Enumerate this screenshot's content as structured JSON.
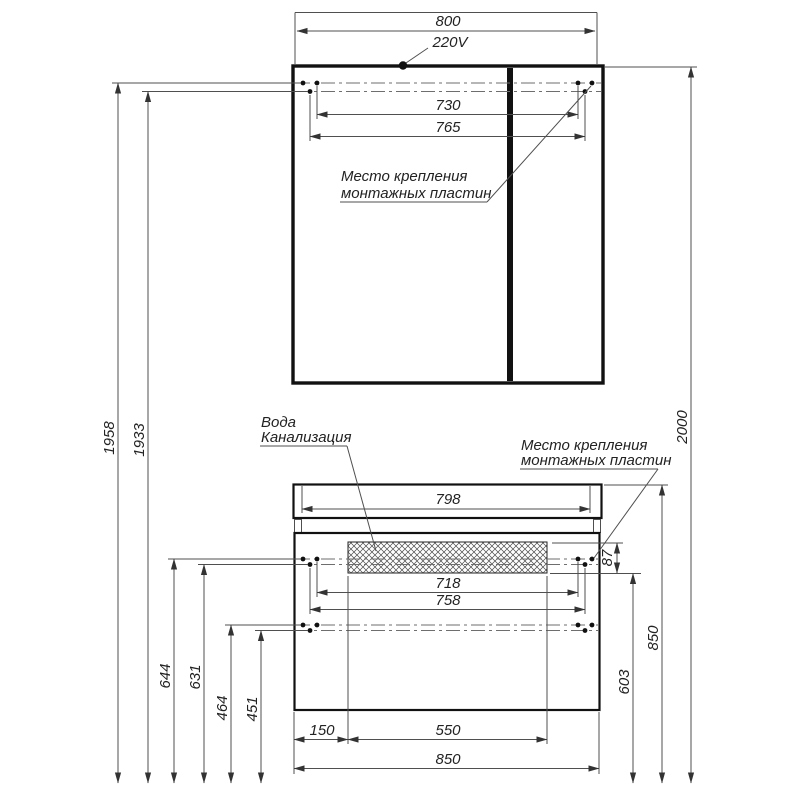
{
  "mirror": {
    "width": "800",
    "power": "220V",
    "mount_span_inner": "730",
    "mount_span_outer": "765",
    "mount_note_line1": "Место крепления",
    "mount_note_line2": "монтажных пластин",
    "height_upper_mount": "1958",
    "height_lower_mount": "1933",
    "height_total": "2000"
  },
  "vanity": {
    "top_width": "798",
    "mount_span_inner": "718",
    "mount_span_outer": "758",
    "mount_plate_height": "87",
    "water_note_line1": "Вода",
    "water_note_line2": "Канализация",
    "mount_note_line1": "Место крепления",
    "mount_note_line2": "монтажных пластин",
    "height_mount_upper_outer": "644",
    "height_mount_upper_inner": "631",
    "height_mount_lower_outer": "464",
    "height_mount_lower_inner": "451",
    "height_side": "603",
    "height_worktop": "850",
    "offset_left": "150",
    "opening_width": "550",
    "width_total": "850"
  }
}
